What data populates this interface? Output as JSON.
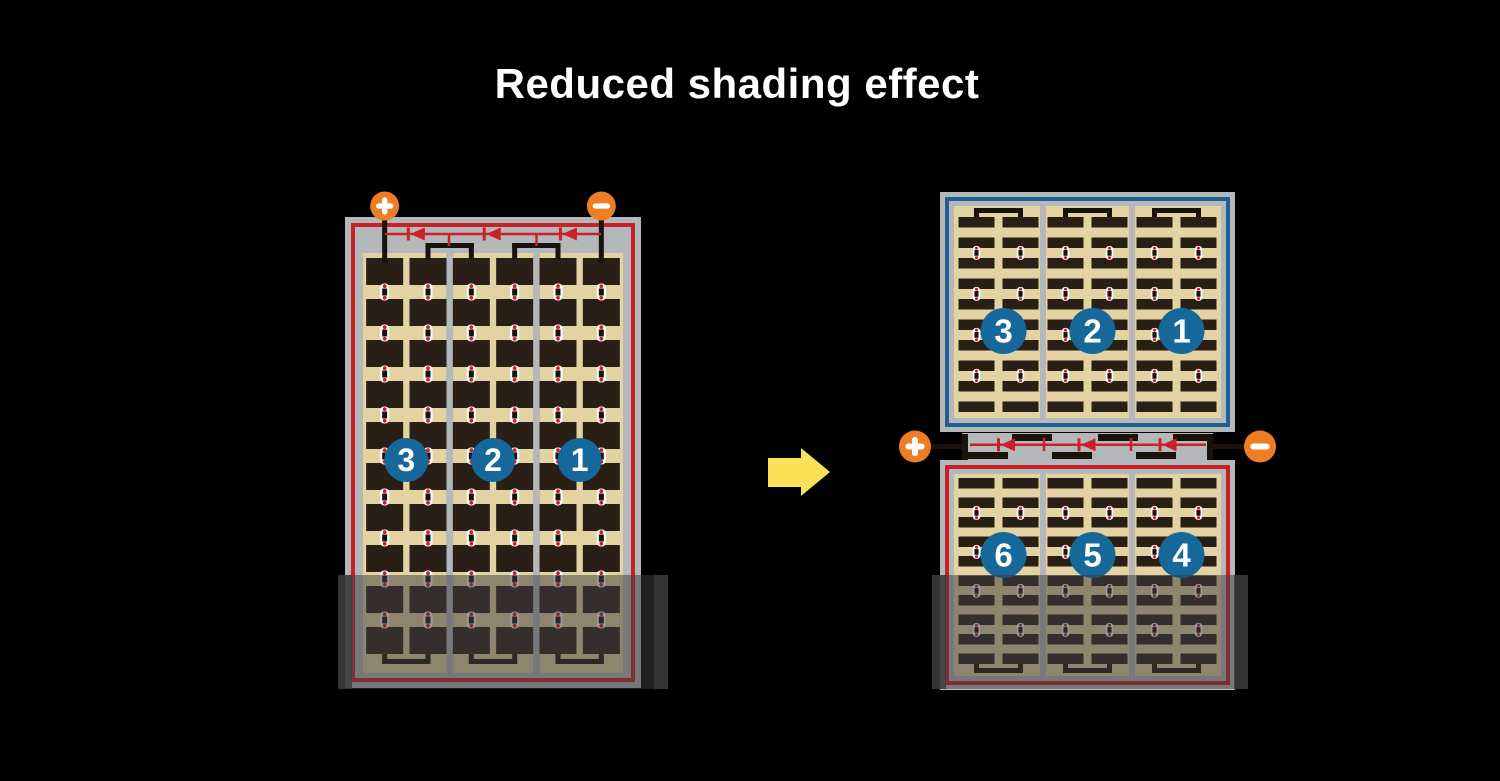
{
  "title": "Reduced shading effect",
  "colors": {
    "background": "#000000",
    "title_text": "#ffffff",
    "frame_gray": "#b5b8ba",
    "panel_tan": "#e3d3a2",
    "cell_dark": "#2a1f17",
    "border_red": "#c52127",
    "border_blue": "#1e6091",
    "terminal_orange": "#ee7d23",
    "string_badge_blue": "#16689b",
    "badge_text": "#ffffff",
    "diode_red": "#cc2027",
    "wire_black": "#1a120c",
    "connector_red": "#cc2027",
    "connector_white": "#ffffff",
    "shade_overlay": "rgba(62,62,64,0.52)",
    "shade_edge": "rgba(58,58,58,0.82)",
    "arrow_yellow": "#f9e257"
  },
  "icons": {
    "arrow": "right-block-arrow",
    "positive_terminal": "plus-circle",
    "negative_terminal": "minus-circle"
  },
  "left_module": {
    "terminals": {
      "positive": "+",
      "negative": "−"
    },
    "strings": [
      {
        "label": "3"
      },
      {
        "label": "2"
      },
      {
        "label": "1"
      }
    ],
    "columns": 6,
    "rows": 10,
    "diodes": 3
  },
  "right_module": {
    "terminals": {
      "positive": "+",
      "negative": "−"
    },
    "top_half": {
      "strings": [
        {
          "label": "3"
        },
        {
          "label": "2"
        },
        {
          "label": "1"
        }
      ]
    },
    "bottom_half": {
      "strings": [
        {
          "label": "6"
        },
        {
          "label": "5"
        },
        {
          "label": "4"
        }
      ]
    },
    "groups": 3,
    "rows_per_half": 10,
    "diodes": 3
  }
}
